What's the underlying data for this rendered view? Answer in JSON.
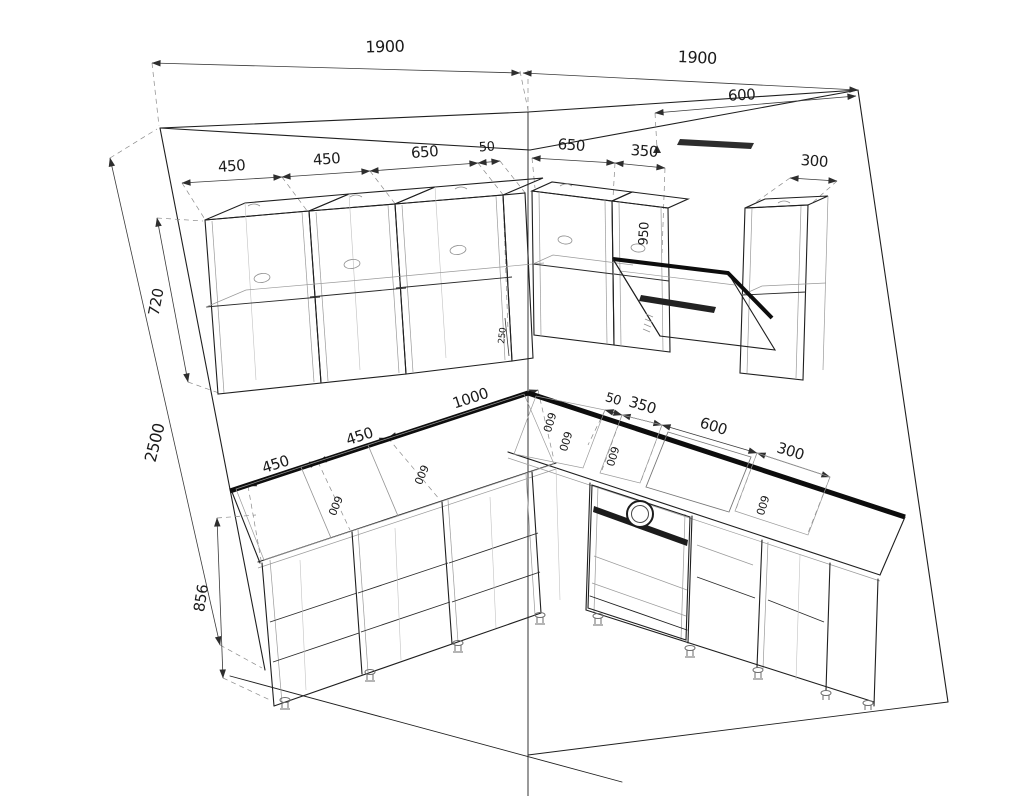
{
  "drawing": {
    "type": "kitchen-corner-perspective-wireframe-with-dimensions",
    "background_color": "#ffffff",
    "line_color": "#1f1f1f",
    "dimension_color": "#3a3a3a",
    "summary": {
      "left_wall_width_mm": 1900,
      "right_wall_width_mm": 1900,
      "wall_height_mm": 2500,
      "upper_cabinet_height_mm": 720,
      "base_cabinet_height_mm": 856,
      "upper_cabinets_left_mm": [
        450,
        450,
        650,
        50
      ],
      "upper_cabinets_right_mm": [
        650,
        350,
        300
      ],
      "hood_zone_width_mm": 600,
      "hood_back_label_mm": 950,
      "base_run_left_mm": [
        450,
        450,
        1000
      ],
      "base_run_right_mm": [
        50,
        350,
        600,
        300
      ],
      "cabinet_depth_labels_mm": [
        600,
        600,
        600,
        600,
        600,
        600
      ],
      "corner_small_label": "250"
    },
    "labels": [
      {
        "v": "1900",
        "x": 385,
        "y": 52,
        "r": -1.6,
        "s": 16,
        "c": "#1b1b1b"
      },
      {
        "v": "1900",
        "x": 697,
        "y": 63,
        "r": 2.8,
        "s": 16,
        "c": "#1b1b1b"
      },
      {
        "v": "600",
        "x": 742,
        "y": 100,
        "r": -3,
        "s": 15,
        "c": "#1b1b1b"
      },
      {
        "v": "450",
        "x": 232,
        "y": 171,
        "r": -4,
        "s": 15,
        "c": "#1b1b1b"
      },
      {
        "v": "450",
        "x": 327,
        "y": 164,
        "r": -4,
        "s": 15,
        "c": "#1b1b1b"
      },
      {
        "v": "650",
        "x": 425,
        "y": 157,
        "r": -4,
        "s": 15,
        "c": "#1b1b1b"
      },
      {
        "v": "50",
        "x": 487,
        "y": 151,
        "r": -4,
        "s": 13,
        "c": "#1b1b1b"
      },
      {
        "v": "650",
        "x": 571,
        "y": 150,
        "r": 4,
        "s": 15,
        "c": "#1b1b1b"
      },
      {
        "v": "350",
        "x": 644,
        "y": 156,
        "r": 4,
        "s": 15,
        "c": "#1b1b1b"
      },
      {
        "v": "300",
        "x": 814,
        "y": 166,
        "r": 4,
        "s": 15,
        "c": "#1b1b1b"
      },
      {
        "v": "720",
        "x": 161,
        "y": 303,
        "r": -79,
        "s": 15,
        "c": "#1b1b1b"
      },
      {
        "v": "2500",
        "x": 160,
        "y": 444,
        "r": -76,
        "s": 16,
        "c": "#1b1b1b"
      },
      {
        "v": "856",
        "x": 206,
        "y": 599,
        "r": -81,
        "s": 15,
        "c": "#1b1b1b"
      },
      {
        "v": "950",
        "x": 648,
        "y": 234,
        "r": -87,
        "s": 13,
        "c": "#9b9b9b"
      },
      {
        "v": "250",
        "x": 505,
        "y": 336,
        "r": -84,
        "s": 9,
        "c": "#555555"
      },
      {
        "v": "450",
        "x": 277,
        "y": 469,
        "r": -18,
        "s": 15,
        "c": "#1b1b1b"
      },
      {
        "v": "450",
        "x": 361,
        "y": 441,
        "r": -18,
        "s": 15,
        "c": "#1b1b1b"
      },
      {
        "v": "1000",
        "x": 472,
        "y": 403,
        "r": -18,
        "s": 15,
        "c": "#1b1b1b"
      },
      {
        "v": "50",
        "x": 612,
        "y": 403,
        "r": 17,
        "s": 13,
        "c": "#1b1b1b"
      },
      {
        "v": "350",
        "x": 641,
        "y": 410,
        "r": 17,
        "s": 15,
        "c": "#1b1b1b"
      },
      {
        "v": "600",
        "x": 712,
        "y": 431,
        "r": 17,
        "s": 15,
        "c": "#1b1b1b"
      },
      {
        "v": "300",
        "x": 789,
        "y": 456,
        "r": 17,
        "s": 15,
        "c": "#1b1b1b"
      },
      {
        "v": "600",
        "x": 332,
        "y": 504,
        "r": 113,
        "s": 11,
        "c": "#787878"
      },
      {
        "v": "600",
        "x": 418,
        "y": 473,
        "r": 113,
        "s": 11,
        "c": "#787878"
      },
      {
        "v": "600",
        "x": 546,
        "y": 421,
        "r": 107,
        "s": 11,
        "c": "#787878"
      },
      {
        "v": "600",
        "x": 562,
        "y": 440,
        "r": 107,
        "s": 11,
        "c": "#787878"
      },
      {
        "v": "600",
        "x": 609,
        "y": 455,
        "r": 107,
        "s": 11,
        "c": "#787878"
      },
      {
        "v": "600",
        "x": 759,
        "y": 504,
        "r": 107,
        "s": 11,
        "c": "#787878"
      }
    ]
  }
}
